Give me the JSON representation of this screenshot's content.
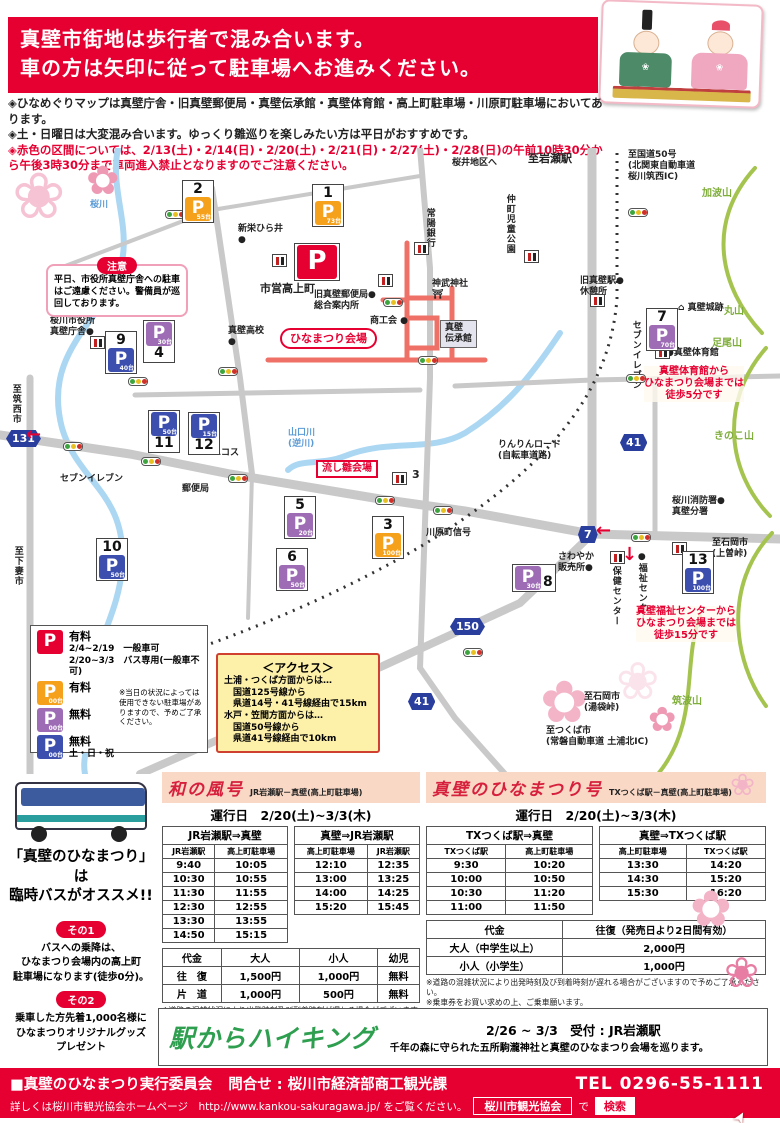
{
  "header": {
    "line1": "真壁市街地は歩行者で混み合います。",
    "line2": "車の方は矢印に従って駐車場へお進みください。"
  },
  "notes": [
    {
      "text": "◈ひなめぐりマップは真壁庁舎・旧真壁郵便局・真壁伝承館・真壁体育館・高上町駐車場・川原町駐車場においてあります。",
      "red": false
    },
    {
      "text": "◈土・日曜日は大変混み合います。ゆっくり雛巡りを楽しみたい方は平日がおすすめです。",
      "red": false
    },
    {
      "text": "◈赤色の区間については、2/13(土)・2/14(日)・2/20(土)・2/21(日)・2/27(土)・2/28(日)の午前10時30分から午後3時30分まで車両進入禁止となりますのでご注意ください。",
      "red": true
    }
  ],
  "map": {
    "caution": {
      "title": "注意",
      "text": "平日、市役所真壁庁舎への駐車はご遠慮ください。警備員が巡回しております。"
    },
    "markers": [
      {
        "id": "2",
        "color": "orange",
        "count": "55台",
        "x": 182,
        "y": 32,
        "numpos": "top"
      },
      {
        "id": "1",
        "color": "orange",
        "count": "73台",
        "x": 312,
        "y": 36,
        "numpos": "top"
      },
      {
        "id": "",
        "color": "red",
        "count": "",
        "x": 294,
        "y": 95,
        "numpos": "none",
        "big": true
      },
      {
        "id": "9",
        "color": "blue",
        "count": "40台",
        "x": 105,
        "y": 183,
        "numpos": "top"
      },
      {
        "id": "4",
        "color": "purple",
        "count": "30台",
        "x": 143,
        "y": 172,
        "numpos": "below"
      },
      {
        "id": "11",
        "color": "blue",
        "count": "50台",
        "x": 148,
        "y": 262,
        "numpos": "below"
      },
      {
        "id": "12",
        "color": "blue",
        "count": "15台",
        "x": 188,
        "y": 264,
        "numpos": "below"
      },
      {
        "id": "10",
        "color": "blue",
        "count": "50台",
        "x": 96,
        "y": 390,
        "numpos": "top"
      },
      {
        "id": "5",
        "color": "purple",
        "count": "20台",
        "x": 284,
        "y": 348,
        "numpos": "top"
      },
      {
        "id": "6",
        "color": "purple",
        "count": "50台",
        "x": 276,
        "y": 400,
        "numpos": "top"
      },
      {
        "id": "3",
        "color": "orange",
        "count": "100台",
        "x": 372,
        "y": 368,
        "numpos": "top"
      },
      {
        "id": "8",
        "color": "purple",
        "count": "30台",
        "x": 512,
        "y": 416,
        "numpos": "right"
      },
      {
        "id": "13",
        "color": "blue",
        "count": "100台",
        "x": 682,
        "y": 403,
        "numpos": "top"
      },
      {
        "id": "7",
        "color": "purple",
        "count": "70台",
        "x": 646,
        "y": 160,
        "numpos": "top"
      }
    ],
    "labels": [
      {
        "name": "label-sakura-river",
        "type": "river-text",
        "text": "桜川",
        "x": 90,
        "y": 52
      },
      {
        "name": "label-city-office",
        "type": "text",
        "text": "桜川市役所\n真壁庁舎●",
        "x": 50,
        "y": 168
      },
      {
        "name": "label-to-chikusei",
        "type": "vtext",
        "text": "至筑西市",
        "x": 10,
        "y": 236
      },
      {
        "name": "badge-131",
        "type": "badge",
        "text": "131",
        "x": 6,
        "y": 282
      },
      {
        "name": "label-to-shimotsuma",
        "type": "vtext",
        "text": "至下妻市",
        "x": 12,
        "y": 398
      },
      {
        "name": "label-seven-eleven-west",
        "type": "text",
        "text": "セブンイレブン",
        "x": 60,
        "y": 326
      },
      {
        "name": "label-post-office",
        "type": "text",
        "text": "郵便局",
        "x": 182,
        "y": 336
      },
      {
        "name": "label-ecos",
        "type": "text",
        "text": "エコス",
        "x": 212,
        "y": 300
      },
      {
        "name": "label-yamaguchi-river",
        "type": "river-text",
        "text": "山口川\n(逆川)",
        "x": 288,
        "y": 280
      },
      {
        "name": "label-nagashibina-venue",
        "type": "redbox",
        "text": "流し雛会場",
        "x": 316,
        "y": 312
      },
      {
        "name": "label-makabe-highschool",
        "type": "text",
        "text": "真壁高校\n●",
        "x": 228,
        "y": 178
      },
      {
        "name": "label-shinei-hirai",
        "type": "text",
        "text": "新栄ひら井\n●",
        "x": 238,
        "y": 76
      },
      {
        "name": "label-shiei-takakamicho",
        "type": "bold",
        "text": "市営高上町",
        "x": 260,
        "y": 134
      },
      {
        "name": "label-old-post-office",
        "type": "text",
        "text": "旧真壁郵便局●\n総合案内所",
        "x": 314,
        "y": 142
      },
      {
        "name": "venue-label",
        "type": "venue",
        "text": "ひなまつり会場",
        "x": 280,
        "y": 180
      },
      {
        "name": "label-shokokai",
        "type": "text",
        "text": "商工会 ●",
        "x": 370,
        "y": 168
      },
      {
        "name": "label-jinmu-shrine",
        "type": "text",
        "text": "神武神社\n⛩",
        "x": 432,
        "y": 131
      },
      {
        "name": "label-denshokan",
        "type": "building",
        "text": "真壁\n伝承館",
        "x": 440,
        "y": 172
      },
      {
        "name": "label-joyo-bank",
        "type": "vtext",
        "text": "常陽銀行",
        "x": 424,
        "y": 60
      },
      {
        "name": "label-nakamachi-park",
        "type": "vtext",
        "text": "仲町児童公園",
        "x": 504,
        "y": 46
      },
      {
        "name": "label-sakurai-area",
        "type": "text",
        "text": "桜井地区へ",
        "x": 452,
        "y": 10
      },
      {
        "name": "label-to-iwase-station",
        "type": "bold",
        "text": "至岩瀬駅",
        "x": 528,
        "y": 4
      },
      {
        "name": "label-to-route50",
        "type": "text",
        "text": "至国道50号\n(北関東自動車道\n桜川筑西IC)",
        "x": 628,
        "y": 2
      },
      {
        "name": "label-mt-kaba",
        "type": "mountain",
        "text": "加波山",
        "x": 702,
        "y": 40
      },
      {
        "name": "label-old-makabe-station",
        "type": "text",
        "text": "旧真壁駅●\n休憩所",
        "x": 580,
        "y": 128
      },
      {
        "name": "label-seven-eleven-east",
        "type": "vtext",
        "text": "セブンイレブン",
        "x": 630,
        "y": 172
      },
      {
        "name": "label-makabe-castle",
        "type": "text",
        "text": "⌂ 真壁城跡",
        "x": 678,
        "y": 155
      },
      {
        "name": "label-mt-maru",
        "type": "mountain",
        "text": "丸山",
        "x": 724,
        "y": 158
      },
      {
        "name": "label-mt-ashio",
        "type": "mountain",
        "text": "足尾山",
        "x": 712,
        "y": 190
      },
      {
        "name": "label-makabe-gym",
        "type": "text",
        "text": "●真壁体育館",
        "x": 666,
        "y": 200
      },
      {
        "name": "note-gym-walk",
        "type": "rednote",
        "text": "真壁体育館から\nひなまつり会場までは\n徒歩5分です",
        "x": 644,
        "y": 218
      },
      {
        "name": "label-mt-kinoko",
        "type": "mountain",
        "text": "きのこ山",
        "x": 714,
        "y": 283
      },
      {
        "name": "label-rinrin-road",
        "type": "text",
        "text": "りんりんロード\n(自転車道路)",
        "x": 498,
        "y": 292
      },
      {
        "name": "badge-41-north",
        "type": "badge",
        "text": "41",
        "x": 620,
        "y": 286
      },
      {
        "name": "label-kawaharacho-signal",
        "type": "text",
        "text": "川原町信号",
        "x": 426,
        "y": 380
      },
      {
        "name": "badge-7",
        "type": "badge",
        "text": "7",
        "x": 578,
        "y": 378
      },
      {
        "name": "label-fire-station",
        "type": "text",
        "text": "桜川消防署●\n真壁分署",
        "x": 672,
        "y": 348
      },
      {
        "name": "label-sawayaka",
        "type": "text",
        "text": "さわやか\n販売所●",
        "x": 558,
        "y": 404
      },
      {
        "name": "label-hoken-center",
        "type": "vtext",
        "text": "保健センター",
        "x": 610,
        "y": 418
      },
      {
        "name": "label-fukushi-center",
        "type": "vtext",
        "text": "●福祉センター",
        "x": 636,
        "y": 404
      },
      {
        "name": "label-to-ishioka-kamiso",
        "type": "text",
        "text": "至石岡市\n(上曽峠)",
        "x": 712,
        "y": 390
      },
      {
        "name": "note-fukushi-walk",
        "type": "rednote",
        "text": "真壁福祉センターから\nひなまつり会場までは\n徒歩15分です",
        "x": 636,
        "y": 458
      },
      {
        "name": "badge-150",
        "type": "badge",
        "text": "150",
        "x": 450,
        "y": 470
      },
      {
        "name": "badge-41-south",
        "type": "badge",
        "text": "41",
        "x": 408,
        "y": 545
      },
      {
        "name": "label-to-ishioka-yubukuro",
        "type": "text",
        "text": "至石岡市\n(湯袋峠)",
        "x": 584,
        "y": 544
      },
      {
        "name": "label-to-tsukuba",
        "type": "text",
        "text": "至つくば市\n(常磐自動車道 土浦北IC)",
        "x": 546,
        "y": 578
      },
      {
        "name": "label-mt-tsukuba",
        "type": "mountain",
        "text": "筑波山",
        "x": 672,
        "y": 548
      },
      {
        "name": "label-parking3-number",
        "type": "bold",
        "text": "3",
        "x": 412,
        "y": 320
      },
      {
        "name": "arrow-down-route41",
        "type": "arrow",
        "text": "↓",
        "x": 622,
        "y": 396
      },
      {
        "name": "arrow-left-route7",
        "type": "arrow",
        "text": "←",
        "x": 596,
        "y": 372
      },
      {
        "name": "arrow-ne-route150",
        "type": "arrow",
        "text": "→",
        "x": 308,
        "y": 516
      },
      {
        "name": "arrow-left-west-road",
        "type": "arrow",
        "text": "←",
        "x": 26,
        "y": 276
      }
    ],
    "signals": [
      [
        165,
        62
      ],
      [
        383,
        150
      ],
      [
        418,
        208
      ],
      [
        628,
        60
      ],
      [
        626,
        226
      ],
      [
        63,
        294
      ],
      [
        141,
        309
      ],
      [
        228,
        326
      ],
      [
        375,
        348
      ],
      [
        433,
        358
      ],
      [
        631,
        385
      ],
      [
        463,
        500
      ],
      [
        128,
        229
      ],
      [
        218,
        219
      ]
    ],
    "toilets": [
      [
        272,
        106
      ],
      [
        90,
        188
      ],
      [
        378,
        126
      ],
      [
        414,
        94
      ],
      [
        524,
        102
      ],
      [
        590,
        146
      ],
      [
        655,
        198
      ],
      [
        392,
        324
      ],
      [
        610,
        403
      ],
      [
        672,
        394
      ]
    ],
    "legend": {
      "rows": [
        {
          "color": "red",
          "count": "",
          "label": "有料",
          "sub": "2/4~2/19　一般車可\n2/20~3/3　バス専用(一般車不可)"
        },
        {
          "color": "orange",
          "count": "00台",
          "label": "有料",
          "sub": ""
        },
        {
          "color": "purple",
          "count": "00台",
          "label": "無料",
          "sub": ""
        },
        {
          "color": "blue",
          "count": "00台",
          "label": "無料",
          "sub": "土・日・祝"
        }
      ],
      "note": "※当日の状況によっては使用できない駐車場がありますので、予めご了承ください。"
    },
    "access": {
      "title": "＜アクセス＞",
      "lines": [
        "土浦・つくば方面からは…",
        "　国道125号線から",
        "　県道14号・41号線経由で15km",
        "水戸・笠間方面からは…",
        "　国道50号線から",
        "　県道41号線経由で10km"
      ]
    }
  },
  "bus": {
    "headline1": "「真壁のひなまつり」は",
    "headline2": "臨時バスがオススメ!!",
    "tip1_label": "その1",
    "tip1_text": "バスへの乗降は、\nひなまつり会場内の高上町\n駐車場になります(徒歩0分)。",
    "tip2_label": "その2",
    "tip2_text": "乗車した方先着1,000名様に\nひなまつりオリジナルグッズ\nプレゼント"
  },
  "wanokaze": {
    "title": "和の風号",
    "subtitle": "JR岩瀬駅－真壁(高上町駐車場)",
    "schedule_label": "運行日　2/20(土)~3/3(木)",
    "dir1": {
      "title": "JR岩瀬駅⇒真壁",
      "cols": [
        "JR岩瀬駅",
        "高上町駐車場"
      ],
      "rows": [
        [
          "9:40",
          "10:05"
        ],
        [
          "10:30",
          "10:55"
        ],
        [
          "11:30",
          "11:55"
        ],
        [
          "12:30",
          "12:55"
        ],
        [
          "13:30",
          "13:55"
        ],
        [
          "14:50",
          "15:15"
        ]
      ]
    },
    "dir2": {
      "title": "真壁⇒JR岩瀬駅",
      "cols": [
        "高上町駐車場",
        "JR岩瀬駅"
      ],
      "rows": [
        [
          "12:10",
          "12:35"
        ],
        [
          "13:00",
          "13:25"
        ],
        [
          "14:00",
          "14:25"
        ],
        [
          "15:20",
          "15:45"
        ]
      ]
    },
    "fare_headers": [
      "代金",
      "大人",
      "小人",
      "幼児"
    ],
    "fare_rows": [
      [
        "往　復",
        "1,500円",
        "1,000円",
        "無料"
      ],
      [
        "片　道",
        "1,000円",
        "500円",
        "無料"
      ]
    ],
    "notes": [
      "※道路の混雑状況により出発時刻及び到着時刻が遅れる場合がございますので予めご了承ください。",
      "※乗車券は、バス乗車後車内にてお求めください。"
    ]
  },
  "hinamatsuri_go": {
    "title": "真壁のひなまつり号",
    "subtitle": "TXつくば駅－真壁(高上町駐車場)",
    "schedule_label": "運行日　2/20(土)~3/3(木)",
    "dir1": {
      "title": "TXつくば駅⇒真壁",
      "cols": [
        "TXつくば駅",
        "高上町駐車場"
      ],
      "rows": [
        [
          "9:30",
          "10:20"
        ],
        [
          "10:00",
          "10:50"
        ],
        [
          "10:30",
          "11:20"
        ],
        [
          "11:00",
          "11:50"
        ]
      ]
    },
    "dir2": {
      "title": "真壁⇒TXつくば駅",
      "cols": [
        "高上町駐車場",
        "TXつくば駅"
      ],
      "rows": [
        [
          "13:30",
          "14:20"
        ],
        [
          "14:30",
          "15:20"
        ],
        [
          "15:30",
          "16:20"
        ]
      ]
    },
    "fare_headers": [
      "代金",
      "往復（発売日より2日間有効）"
    ],
    "fare_rows": [
      [
        "大人（中学生以上）",
        "2,000円"
      ],
      [
        "小人（小学生）",
        "1,000円"
      ]
    ],
    "notes": [
      "※道路の混雑状況により出発時刻及び到着時刻が遅れる場合がございますので予めご了承ください。",
      "※乗車券をお買い求めの上、ご乗車願います。",
      "　発売場所:関鉄つくば学園営業所(TXつくば駅前バスターミナル横)"
    ]
  },
  "hiking": {
    "logo": "駅からハイキング",
    "period": "2/26 ~ 3/3　受付 : JR岩瀬駅",
    "desc": "千年の森に守られた五所駒瀧神社と真壁のひなまつり会場を巡ります。"
  },
  "footer": {
    "committee": "■真壁のひなまつり実行委員会",
    "contact": "問合せ : 桜川市経済部商工観光課",
    "tel": "TEL 0296-55-1111",
    "homepage_line": "詳しくは桜川市観光協会ホームページ　http://www.kankou-sakuragawa.jp/ をご覧ください。",
    "search_box": "桜川市観光協会",
    "de": "で",
    "search_button": "検索"
  },
  "colors": {
    "accent_red": "#e60032",
    "orange_parking": "#f6a11c",
    "purple_parking": "#9d6cb5",
    "blue_parking": "#3c4fae",
    "access_bg": "#fdf0a8",
    "hiking_green": "#2e9e4f"
  }
}
